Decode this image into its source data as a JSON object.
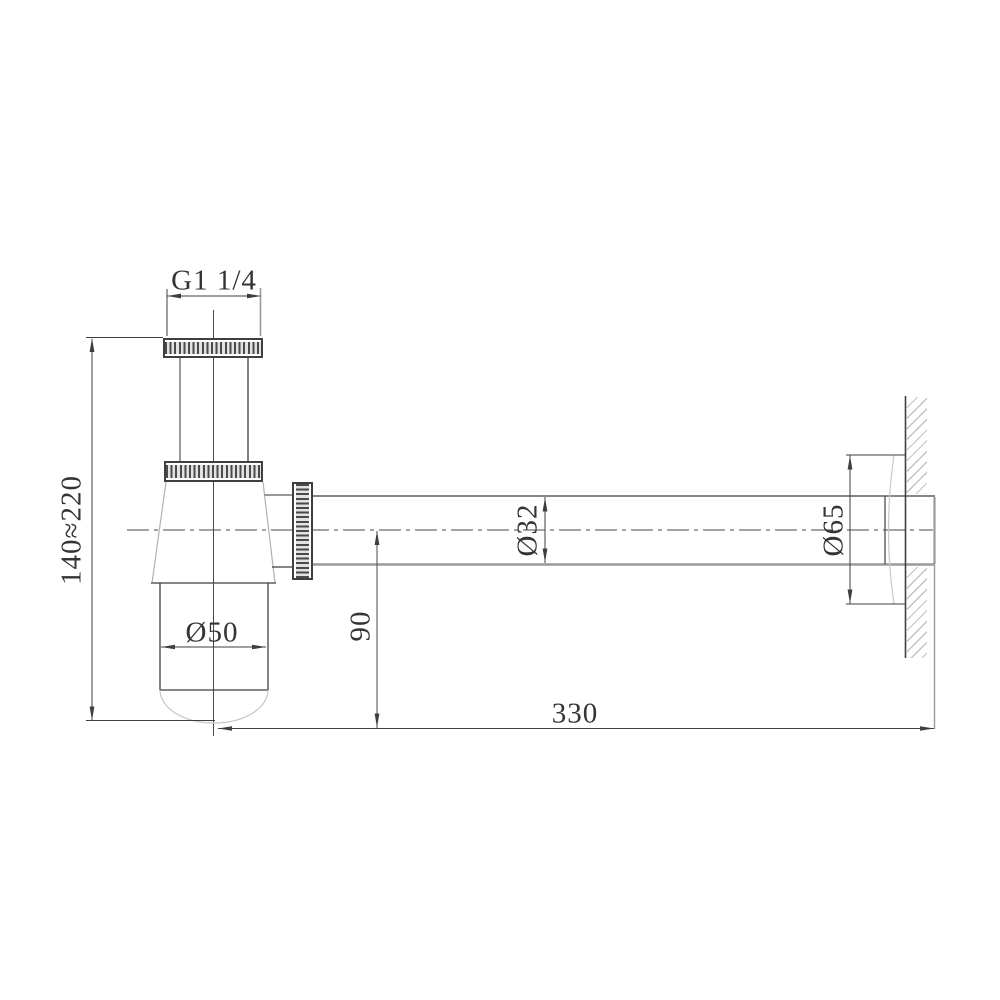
{
  "drawing": {
    "kind": "technical-dimension-drawing",
    "dimensions": {
      "thread_size": "G1 1/4",
      "body_height_range": "140≈220",
      "cup_diameter": "Ø50",
      "pipe_diameter": "Ø32",
      "outlet_drop": "90",
      "flange_diameter": "Ø65",
      "pipe_length": "330"
    },
    "colors": {
      "line_dark": "#3f3f3f",
      "line_gray": "#9a9a9a",
      "line_light": "#c6c6c6",
      "background": "#ffffff"
    }
  }
}
